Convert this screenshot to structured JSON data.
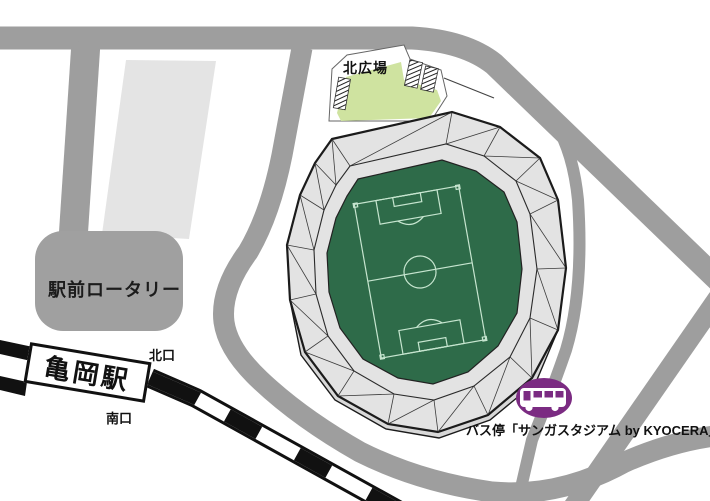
{
  "map": {
    "title": "Sanga Stadium access map",
    "station": {
      "name": "亀岡駅",
      "north_exit": "北口",
      "south_exit": "南口"
    },
    "rotary": {
      "label": "駅前ロータリー"
    },
    "plaza": {
      "label": "北広場"
    },
    "bus_stop": {
      "label": "バス停「サンガスタジアム by KYOCERA」",
      "icon": "bus-icon"
    },
    "colors": {
      "road": "#9e9e9e",
      "rotary_gray": "#a0a0a0",
      "parking_gray": "#e4e4e4",
      "roof_gray": "#e3e3e3",
      "wall_gray": "#d8d8d8",
      "outline": "#1b1b1b",
      "plaza_green": "#cfe3a0",
      "pitch_green": "#2e6b49",
      "pitch_line": "#c6e5cf",
      "bus_purple": "#7b2b82",
      "railway_black": "#111111"
    }
  }
}
